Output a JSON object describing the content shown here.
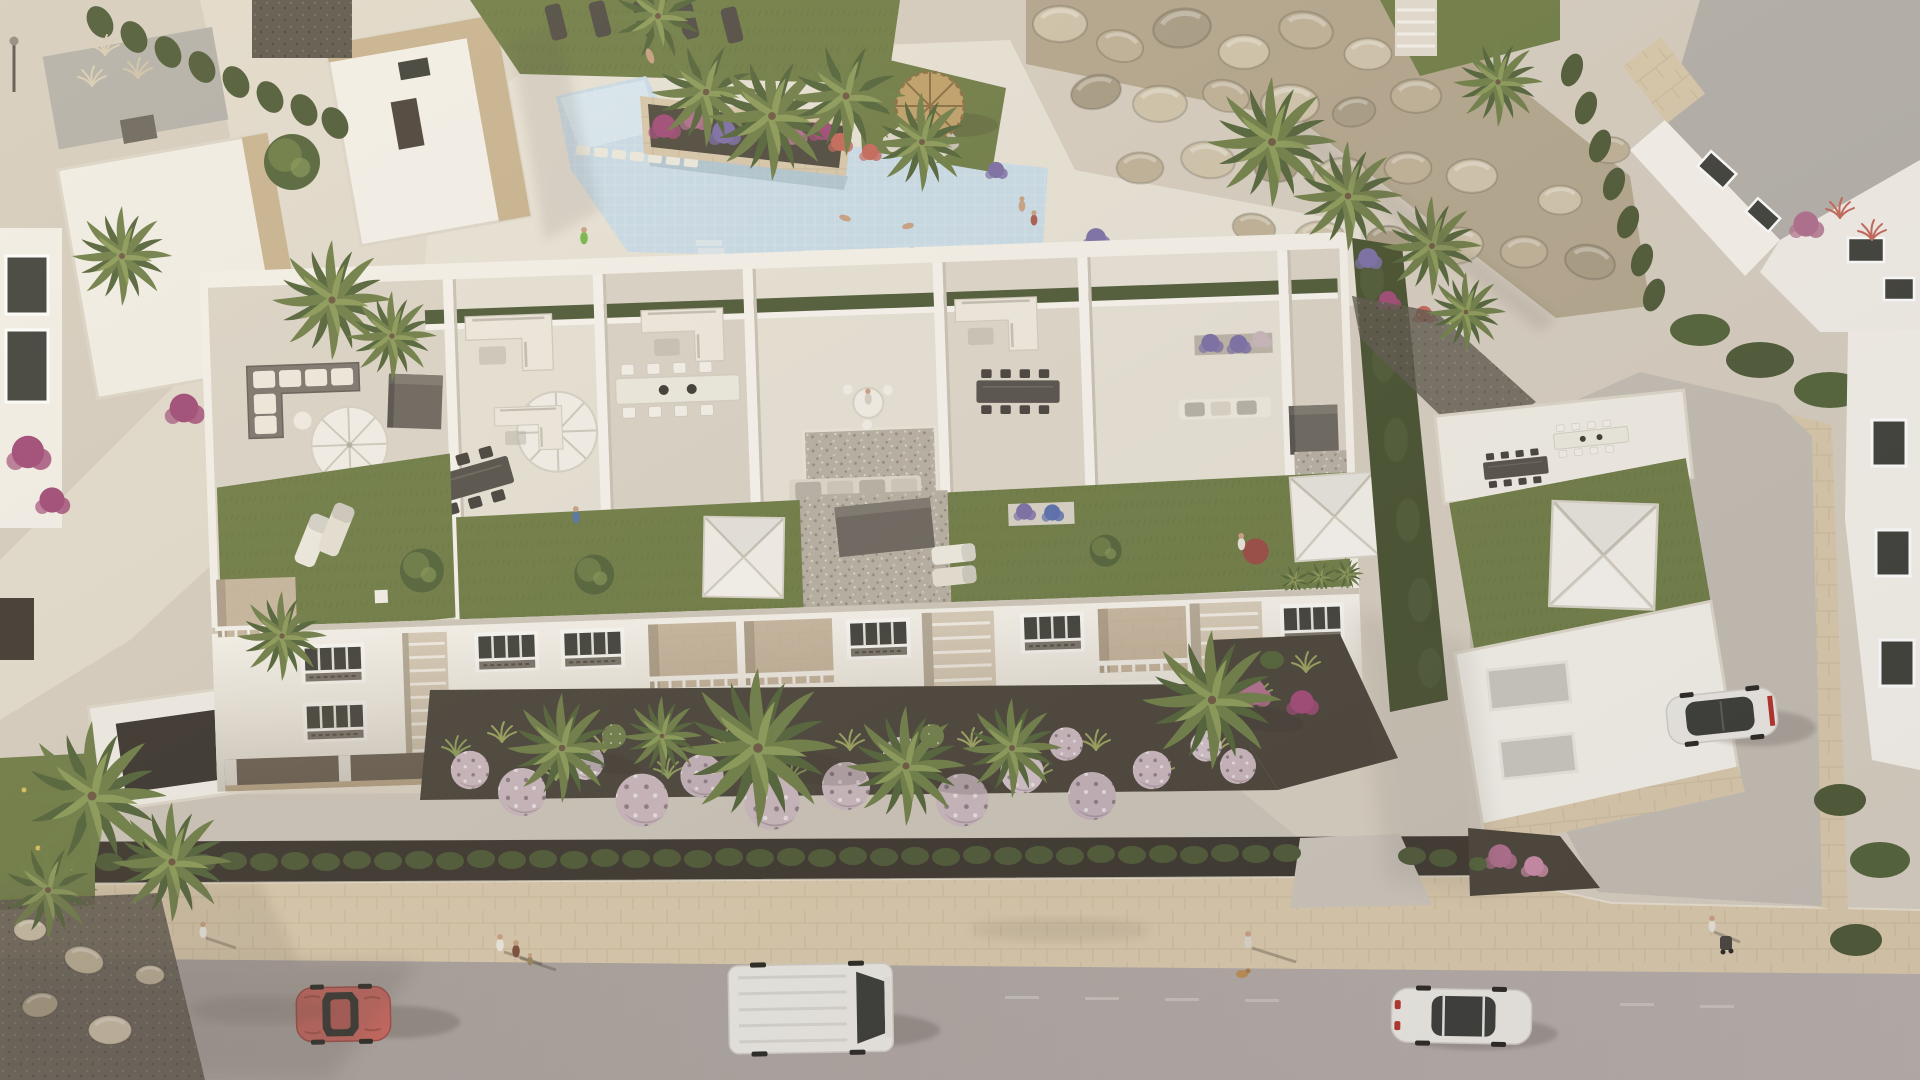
{
  "scene": {
    "type": "aerial-architectural-render",
    "subject": "mediterranean-white-apartment-complex-with-roof-terraces",
    "time_of_day": "golden-hour",
    "features": [
      "swimming-pool",
      "rooftop-terraces",
      "green-roofs",
      "white-parasols",
      "straw-parasol",
      "boulder-rockery-wall",
      "ornamental-garden",
      "lavender-ball-shrubs",
      "palm-trees",
      "street-with-cars",
      "stone-sidewalk",
      "hedge-row",
      "villas",
      "driveway",
      "garage"
    ],
    "vehicles": [
      {
        "name": "red-coupe",
        "state": "driving-left-lane"
      },
      {
        "name": "white-van",
        "state": "driving-left-lane"
      },
      {
        "name": "white-sedan",
        "state": "driving-right"
      },
      {
        "name": "white-parked-car",
        "state": "parked-in-driveway"
      }
    ],
    "people_visible": 15
  },
  "colors": {
    "paving": "#d6cec0",
    "pavingLight": "#e2dbcd",
    "deck": "#e8e3d7",
    "promenade": "#cbc4b8",
    "road": "#aba39e",
    "roadLight": "#b8afab",
    "stone": "#d8c8ab",
    "stoneLine": "#c2b091",
    "mulch": "#3c372f",
    "soil": "#4a443a",
    "lawn": "#6f7d46",
    "lawnLight": "#84914f",
    "hedge": "#4e5a37",
    "palm": "#6f7f48",
    "palmDark": "#53643a",
    "palmLight": "#8b9b59",
    "bldg": "#f5f2ea",
    "bldgShade": "#d8d2c4",
    "wallLine": "#c9c2b3",
    "roofTile": "#dcd5c8",
    "roofTileLight": "#e7e2d6",
    "roofGray": "#b4b1aa",
    "gravel": "#b7b0a3",
    "gravelDark": "#5d574c",
    "box": "#6b665e",
    "boxTop": "#7d786f",
    "sofaWhite": "#efeadf",
    "cushion": "#b7b1a5",
    "furnDark": "#55514a",
    "umbrella": "#f3f0e9",
    "umbrellaShade": "#d9d4c7",
    "straw": "#c0a169",
    "water": "#c9dce8",
    "waterLight": "#dcebf2",
    "glass": "#3f403a",
    "ballLavender": "#c8b6bc",
    "magenta": "#a04a77",
    "purple": "#7b6fa6",
    "coral": "#c4685a",
    "pinkBush": "#b06f8d",
    "carRed": "#c5655d",
    "carWhite": "#eae8e2",
    "vanWhite": "#e9e7e1",
    "hotTub": "#4173a3",
    "hotTubWater": "#86b7da",
    "skin": "#c9a183",
    "shadow": "#3a332a",
    "stoneTan": "#c9b491",
    "boulder1": "#d0c4ab",
    "boulder2": "#bfb298",
    "boulder3": "#a99d85"
  }
}
